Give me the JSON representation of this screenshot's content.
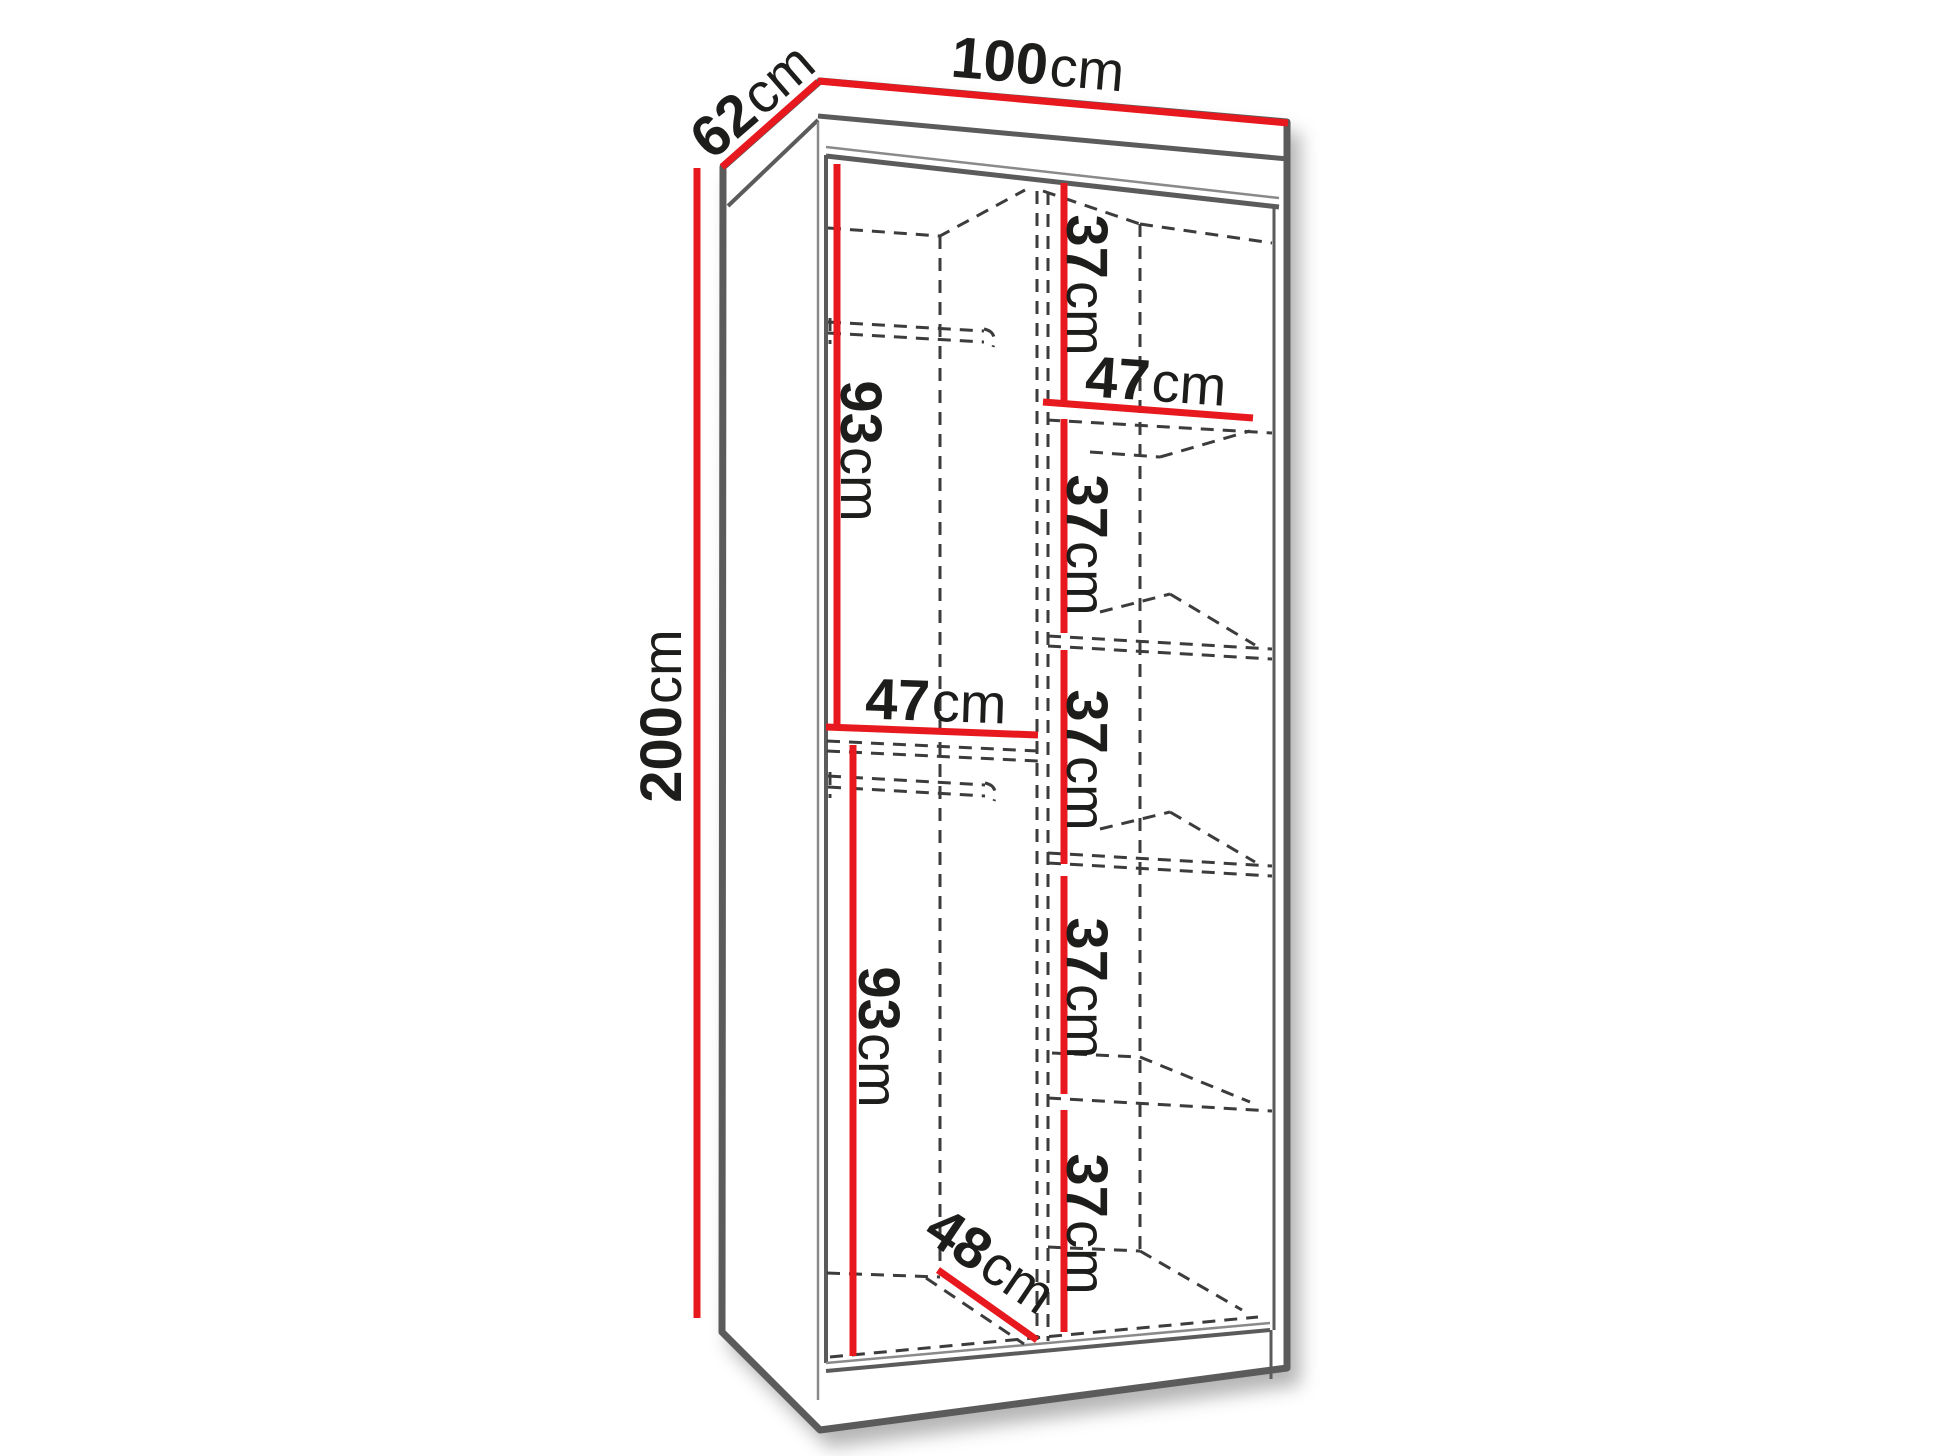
{
  "labels": {
    "width": {
      "value": "100",
      "unit": "cm"
    },
    "depth": {
      "value": "62",
      "unit": "cm"
    },
    "height": {
      "value": "200",
      "unit": "cm"
    },
    "hanging_top": {
      "value": "93",
      "unit": "cm"
    },
    "hanging_bottom": {
      "value": "93",
      "unit": "cm"
    },
    "left_compartment_width": {
      "value": "47",
      "unit": "cm"
    },
    "right_compartment_width": {
      "value": "47",
      "unit": "cm"
    },
    "usable_depth": {
      "value": "48",
      "unit": "cm"
    },
    "shelf_gaps": [
      {
        "value": "37",
        "unit": "cm"
      },
      {
        "value": "37",
        "unit": "cm"
      },
      {
        "value": "37",
        "unit": "cm"
      },
      {
        "value": "37",
        "unit": "cm"
      },
      {
        "value": "37",
        "unit": "cm"
      }
    ]
  },
  "colors": {
    "dimension_red": "#e8191e",
    "outline_gray": "#5b5b5b",
    "dashed_gray": "#3c3c3c",
    "label_black": "#1d1d1b",
    "background": "#ffffff"
  }
}
